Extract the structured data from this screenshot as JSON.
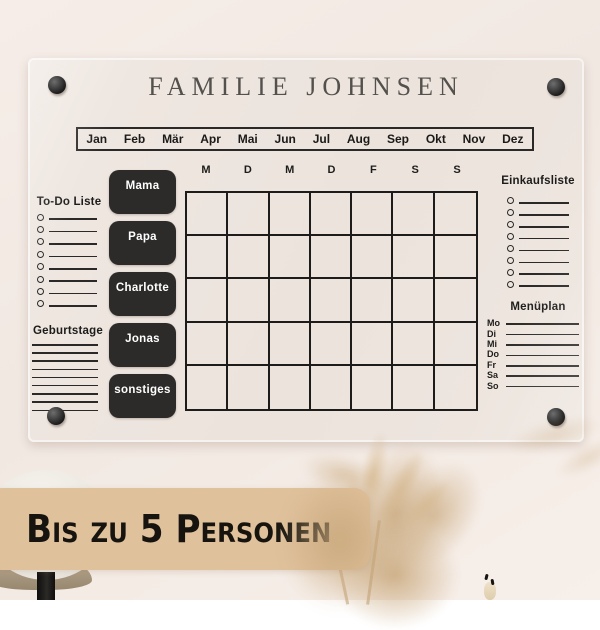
{
  "colors": {
    "wall": "#f3eae4",
    "board": "#ece4dd",
    "ink": "#1d1c1a",
    "tag_bg": "#2d2b2a",
    "tag_text": "#ffffff",
    "banner_bg": "#dfc19c",
    "banner_text": "#17140f",
    "pampas": "#c9a87c",
    "title_color": "#54514d"
  },
  "board": {
    "title": "FAMILIE JOHNSEN",
    "months": [
      "Jan",
      "Feb",
      "Mär",
      "Apr",
      "Mai",
      "Jun",
      "Jul",
      "Aug",
      "Sep",
      "Okt",
      "Nov",
      "Dez"
    ],
    "weekday_headers": [
      "M",
      "D",
      "M",
      "D",
      "F",
      "S",
      "S"
    ],
    "member_tags": [
      "Mama",
      "Papa",
      "Charlotte",
      "Jonas",
      "sonstiges"
    ],
    "todo_list": {
      "title": "To-Do Liste",
      "item_count": 8
    },
    "birthdays": {
      "title": "Geburtstage",
      "line_count": 9
    },
    "shopping_list": {
      "title": "Einkaufsliste",
      "item_count": 8
    },
    "menu_plan": {
      "title": "Menüplan",
      "days": [
        "Mo",
        "Di",
        "Mi",
        "Do",
        "Fr",
        "Sa",
        "So"
      ]
    },
    "grid": {
      "rows": 5,
      "columns": 7
    }
  },
  "banner": {
    "text": "Bis zu 5 Personen"
  }
}
